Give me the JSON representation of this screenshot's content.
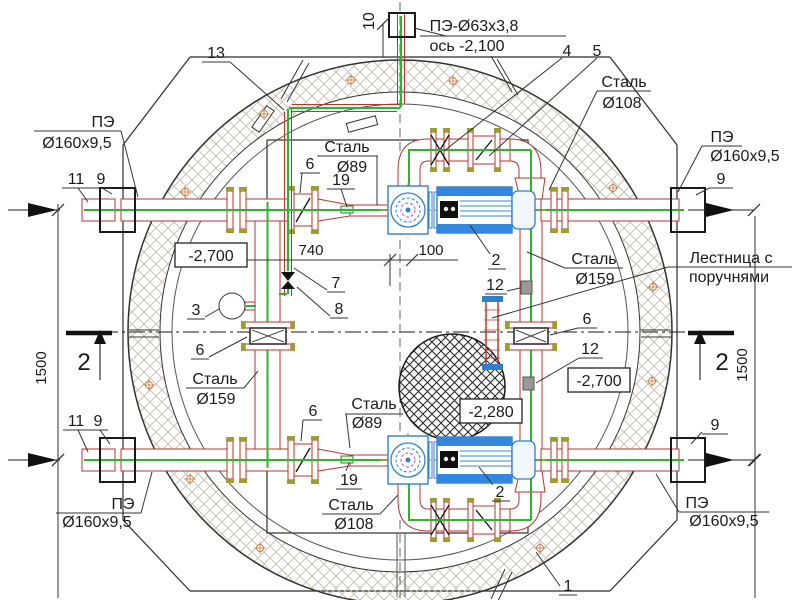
{
  "drawing_type": "pump-station-plan-view",
  "labels": {
    "pe63": "ПЭ-Ø63х3,8",
    "axis63": "ось -2,100",
    "steel": "Сталь",
    "d89": "Ø89",
    "d108": "Ø108",
    "d159": "Ø159",
    "pe": "ПЭ",
    "d160": "Ø160х9,5",
    "ladder1": "Лестница с",
    "ladder2": "поручнями"
  },
  "callouts": {
    "c1": "1",
    "c2": "2",
    "c3": "3",
    "c4": "4",
    "c5": "5",
    "c6": "6",
    "c7": "7",
    "c8": "8",
    "c9": "9",
    "c10": "10",
    "c11": "11",
    "c12": "12",
    "c13": "13",
    "c19": "19"
  },
  "elevations": {
    "e2700": "-2,700",
    "e2280": "-2,280"
  },
  "dims": {
    "d740": "740",
    "d100": "100",
    "d1500": "1500"
  },
  "section": {
    "s2": "2"
  },
  "colors": {
    "pipe": "#b5372e",
    "centerline": "#2db52d",
    "motor_blue": "#2f7fd0",
    "axis_orange": "#e0922f",
    "ring_hatch": "#ccc3b8",
    "anchor": "#b5651d",
    "bolt": "#9aa02c"
  }
}
